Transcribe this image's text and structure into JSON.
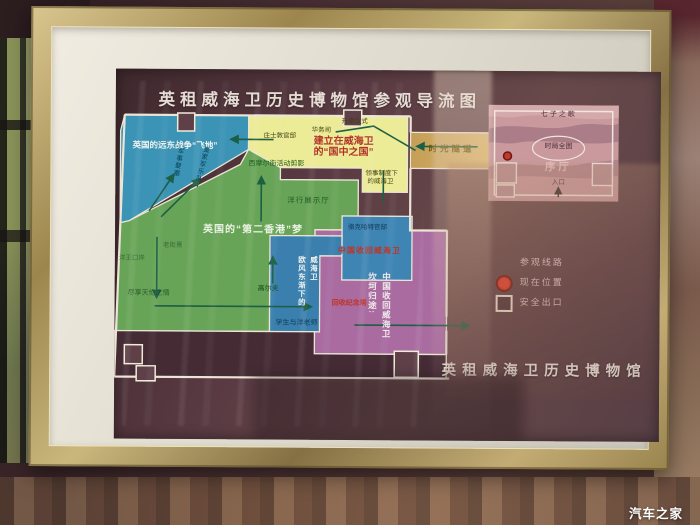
{
  "watermark": "汽车之家",
  "colors": {
    "zone_enclave_blue": "#3b93b5",
    "zone_state_yellow": "#eceb96",
    "zone_hk_green": "#68a457",
    "zone_euro_blue": "#3a7fae",
    "zone_return_purple": "#a96ba0",
    "corridor_tan": "#d4ad63",
    "hall_pink": "#c9999e",
    "route_green": "#1b5f44",
    "accent_red": "#bf3326",
    "frame_gold": "#c9b77c"
  },
  "poster": {
    "title": "英租威海卫历史博物馆参观导流图",
    "museum_name": "英租威海卫历史博物馆",
    "corridor_label": "时光隧道",
    "legend": {
      "route": "参观线路",
      "current_position": "现在位置",
      "safety_exit": "安全出口"
    },
    "hall": {
      "song": "七子之歌",
      "map_oval": "时局全图",
      "name": "序厅",
      "entrance": "入口"
    },
    "zone_enclave": {
      "title": "英国的远东战争“飞地”",
      "fortress": "军事要塞",
      "band": "皇家军乐队"
    },
    "zone_state": {
      "title_line1": "建立在威海卫",
      "title_line2": "的“国中之国”",
      "johnston": "庄士敦官邸",
      "chinese_affairs": "华务司",
      "flag_ceremony": "升旗仪式",
      "consul_line1": "领事制度下",
      "consul_line2": "的威海卫"
    },
    "zone_hk": {
      "title": "英国的“第二香港”梦",
      "seymour": "西摩尔街活动剪影",
      "firm_hall": "洋行展示厅",
      "street": "老街景",
      "port": "洋王口岸",
      "family": "尽享天伦之情",
      "golf": "高尔夫"
    },
    "zone_euro": {
      "title_col_left": "欧风东渐下的",
      "title_col_right": "威海卫",
      "students": "学生与洋老师"
    },
    "zone_return": {
      "title_col_left": "坎坷归途:",
      "title_col_right": "中国收回威海卫",
      "lockhart": "骆克哈特官邸",
      "recover": "中国收回威海卫",
      "tower": "回收纪念塔"
    }
  }
}
